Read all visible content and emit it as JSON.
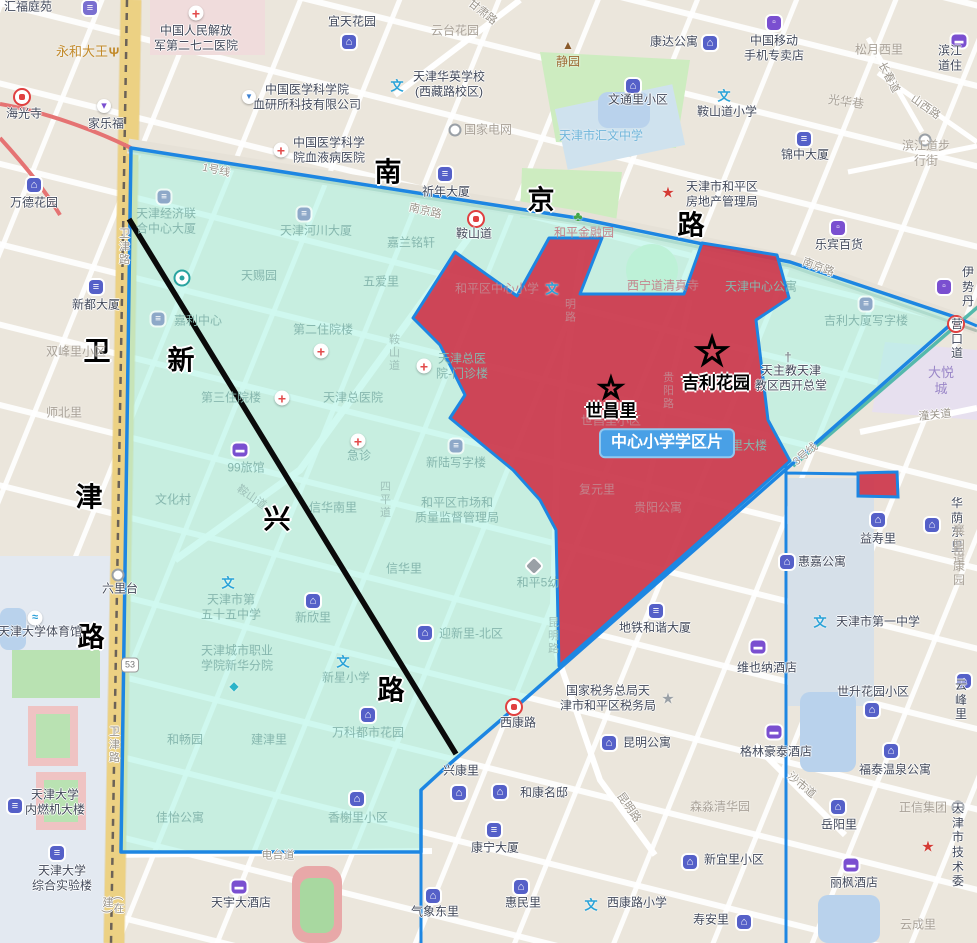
{
  "map": {
    "title": "天津市和平区 中心小学学区片 地图",
    "district_badge": "中心小学学区片",
    "colors": {
      "boundary_blue": "#1d86e2",
      "district_cyan": "rgba(190,250,240,0.6)",
      "school_zone_red": "#ce384c",
      "badge_blue": "#49a0e6",
      "highlight_line_black": "#000000",
      "weijin_road_yellow": "#f2d98f"
    },
    "labels": [
      {
        "t": "汇福庭苑",
        "x": 28,
        "y": 7,
        "c": "dark",
        "i": "bank",
        "ix": 90,
        "iy": 8
      },
      {
        "t": "永和大王",
        "x": 82,
        "y": 52,
        "c": "orange",
        "i": "fork",
        "ix": 114,
        "iy": 52
      },
      {
        "t": "中国人民解放\n军第二七二医院",
        "x": 196,
        "y": 38,
        "c": "dark",
        "i": "cross",
        "ix": 196,
        "iy": 13
      },
      {
        "t": "海光寺",
        "x": 24,
        "y": 114,
        "c": "dark",
        "i": "metro",
        "ix": 22,
        "iy": 97
      },
      {
        "t": "家乐福",
        "x": 106,
        "y": 124,
        "c": "dark",
        "i": "cart",
        "ix": 104,
        "iy": 106
      },
      {
        "t": "中国医学科学院\n血研所科技有限公司",
        "x": 307,
        "y": 97,
        "c": "dark",
        "i": "flask",
        "ix": 249,
        "iy": 97
      },
      {
        "t": "中国医学科学\n院血液病医院",
        "x": 329,
        "y": 150,
        "c": "dark",
        "i": "cross",
        "ix": 281,
        "iy": 150
      },
      {
        "t": "万德花园",
        "x": 34,
        "y": 203,
        "c": "dark",
        "i": "home",
        "ix": 34,
        "iy": 185
      },
      {
        "t": "宜天花园",
        "x": 352,
        "y": 22,
        "c": "dark",
        "i": "home",
        "ix": 349,
        "iy": 42
      },
      {
        "t": "云台花园",
        "x": 455,
        "y": 31,
        "c": "gray"
      },
      {
        "t": "甘肃路",
        "x": 482,
        "y": 13,
        "c": "road",
        "r": 38
      },
      {
        "t": "静园",
        "x": 568,
        "y": 62,
        "c": "brown",
        "i": "temple",
        "ix": 568,
        "iy": 45
      },
      {
        "t": "天津华英学校\n(西藏路校区)",
        "x": 449,
        "y": 84,
        "c": "dark",
        "i": "school",
        "ix": 397,
        "iy": 86
      },
      {
        "t": "国家电网",
        "x": 488,
        "y": 130,
        "c": "gray",
        "i": "circ",
        "ix": 455,
        "iy": 130
      },
      {
        "t": "文通里小区",
        "x": 638,
        "y": 100,
        "c": "dark",
        "i": "home",
        "ix": 633,
        "iy": 86
      },
      {
        "t": "天津市汇文中学",
        "x": 601,
        "y": 136,
        "c": "blue"
      },
      {
        "t": "康达公寓",
        "x": 674,
        "y": 42,
        "c": "dark",
        "i": "home",
        "ix": 710,
        "iy": 43
      },
      {
        "t": "中国移动\n手机专卖店",
        "x": 774,
        "y": 48,
        "c": "dark",
        "i": "shopbag",
        "ix": 774,
        "iy": 23
      },
      {
        "t": "松月西里",
        "x": 879,
        "y": 50,
        "c": "gray"
      },
      {
        "t": "滨江道住",
        "x": 950,
        "y": 58,
        "c": "dark",
        "i": "bed",
        "ix": 959,
        "iy": 41
      },
      {
        "t": "鞍山道小学",
        "x": 727,
        "y": 112,
        "c": "dark",
        "i": "school",
        "ix": 724,
        "iy": 96
      },
      {
        "t": "光华巷",
        "x": 846,
        "y": 102,
        "c": "gray",
        "r": 8
      },
      {
        "t": "锦中大厦",
        "x": 805,
        "y": 155,
        "c": "dark",
        "i": "bldg",
        "ix": 804,
        "iy": 139
      },
      {
        "t": "滨江道步行街",
        "x": 926,
        "y": 153,
        "c": "gray",
        "i": "circ",
        "ix": 925,
        "iy": 140
      },
      {
        "t": "长春道",
        "x": 888,
        "y": 78,
        "c": "road",
        "r": 62
      },
      {
        "t": "山西路",
        "x": 925,
        "y": 108,
        "c": "road",
        "r": 35
      },
      {
        "t": "天津市和平区\n房地产管理局",
        "x": 722,
        "y": 194,
        "c": "dark",
        "i": "starred",
        "ix": 668,
        "iy": 193
      },
      {
        "t": "乐宾百货",
        "x": 839,
        "y": 245,
        "c": "dark",
        "i": "shopbag",
        "ix": 838,
        "iy": 228
      },
      {
        "t": "伊势丹",
        "x": 968,
        "y": 287,
        "c": "dark",
        "i": "shopbag",
        "ix": 944,
        "iy": 287
      },
      {
        "t": "营口道",
        "x": 957,
        "y": 339,
        "c": "dark",
        "i": "metro",
        "ix": 956,
        "iy": 324
      },
      {
        "t": "大悦城",
        "x": 941,
        "y": 381,
        "c": "purple"
      },
      {
        "t": "潼关道",
        "x": 935,
        "y": 416,
        "c": "road",
        "r": -6
      },
      {
        "t": "祈年大厦",
        "x": 446,
        "y": 192,
        "c": "dark",
        "i": "bldg",
        "ix": 445,
        "iy": 174
      },
      {
        "t": "鞍山道",
        "x": 474,
        "y": 234,
        "c": "dark",
        "i": "metro",
        "ix": 476,
        "iy": 219
      },
      {
        "t": "南京路",
        "x": 425,
        "y": 212,
        "c": "road",
        "r": 13
      },
      {
        "t": "南京路",
        "x": 818,
        "y": 268,
        "c": "road",
        "r": 20
      },
      {
        "t": "1号线",
        "x": 216,
        "y": 171,
        "c": "road",
        "r": 12
      },
      {
        "t": "3号线",
        "x": 806,
        "y": 455,
        "c": "road",
        "r": -40
      },
      {
        "t": "南",
        "x": 388,
        "y": 173,
        "c": "big"
      },
      {
        "t": "京",
        "x": 541,
        "y": 201,
        "c": "big"
      },
      {
        "t": "路",
        "x": 691,
        "y": 226,
        "c": "big"
      },
      {
        "t": "卫",
        "x": 97,
        "y": 352,
        "c": "big"
      },
      {
        "t": "津",
        "x": 89,
        "y": 498,
        "c": "big"
      },
      {
        "t": "路",
        "x": 91,
        "y": 638,
        "c": "big"
      },
      {
        "t": "新",
        "x": 181,
        "y": 361,
        "c": "big"
      },
      {
        "t": "兴",
        "x": 277,
        "y": 520,
        "c": "big"
      },
      {
        "t": "路",
        "x": 391,
        "y": 691,
        "c": "big"
      },
      {
        "t": "天津经济联\n合中心大厦",
        "x": 166,
        "y": 221,
        "c": "dim",
        "i": "bldgdim",
        "ix": 164,
        "iy": 197
      },
      {
        "t": "天津河川大厦",
        "x": 316,
        "y": 231,
        "c": "dim",
        "i": "bldgdim",
        "ix": 304,
        "iy": 214
      },
      {
        "t": "嘉兰铭轩",
        "x": 411,
        "y": 243,
        "c": "dim"
      },
      {
        "t": "天赐园",
        "x": 259,
        "y": 276,
        "c": "dim"
      },
      {
        "t": "五爱里",
        "x": 381,
        "y": 282,
        "c": "dim"
      },
      {
        "t": "嘉利中心",
        "x": 198,
        "y": 321,
        "c": "dim",
        "i": "bldgdim",
        "ix": 158,
        "iy": 319
      },
      {
        "t": "",
        "x": 182,
        "y": 278,
        "c": "dim",
        "i": "mobile",
        "ix": 182,
        "iy": 278
      },
      {
        "t": "第二住院楼",
        "x": 323,
        "y": 330,
        "c": "dim",
        "i": "cross",
        "ix": 321,
        "iy": 351
      },
      {
        "t": "第三住院楼",
        "x": 231,
        "y": 398,
        "c": "dim",
        "i": "cross",
        "ix": 282,
        "iy": 398
      },
      {
        "t": "双峰里小区",
        "x": 76,
        "y": 352,
        "c": "gray"
      },
      {
        "t": "新都大厦",
        "x": 96,
        "y": 305,
        "c": "dark",
        "i": "bldg",
        "ix": 96,
        "iy": 287
      },
      {
        "t": "师北里",
        "x": 64,
        "y": 413,
        "c": "gray"
      },
      {
        "t": "卫津路",
        "x": 123,
        "y": 247,
        "c": "road",
        "v": true
      },
      {
        "t": "卫津路",
        "x": 113,
        "y": 745,
        "c": "road",
        "v": true
      },
      {
        "t": "(在建)",
        "x": 112,
        "y": 906,
        "c": "road",
        "v": true
      },
      {
        "t": "鞍山道",
        "x": 393,
        "y": 353,
        "c": "roaddim",
        "v": true
      },
      {
        "t": "鞍山道",
        "x": 251,
        "y": 498,
        "c": "roaddim",
        "r": 35
      },
      {
        "t": "天津总医\n院-门诊楼",
        "x": 462,
        "y": 366,
        "c": "dim",
        "i": "cross",
        "ix": 424,
        "iy": 366
      },
      {
        "t": "天津总医院",
        "x": 353,
        "y": 398,
        "c": "dim"
      },
      {
        "t": "急诊",
        "x": 359,
        "y": 456,
        "c": "dim",
        "i": "cross",
        "ix": 358,
        "iy": 441
      },
      {
        "t": "99旅馆",
        "x": 246,
        "y": 468,
        "c": "dim",
        "i": "bed",
        "ix": 240,
        "iy": 450
      },
      {
        "t": "文化村",
        "x": 173,
        "y": 500,
        "c": "dim"
      },
      {
        "t": "信华南里",
        "x": 333,
        "y": 508,
        "c": "dim"
      },
      {
        "t": "四平道",
        "x": 384,
        "y": 500,
        "c": "roaddim",
        "v": true
      },
      {
        "t": "新陆写字楼",
        "x": 456,
        "y": 463,
        "c": "dim",
        "i": "bldgdim",
        "ix": 456,
        "iy": 446
      },
      {
        "t": "和平区市场和\n质量监督管理局",
        "x": 457,
        "y": 510,
        "c": "dim"
      },
      {
        "t": "信华里",
        "x": 404,
        "y": 569,
        "c": "dim"
      },
      {
        "t": "天津市第\n五十五中学",
        "x": 231,
        "y": 607,
        "c": "dim",
        "i": "school",
        "ix": 228,
        "iy": 583
      },
      {
        "t": "新欣里",
        "x": 313,
        "y": 618,
        "c": "dim",
        "i": "home",
        "ix": 313,
        "iy": 601
      },
      {
        "t": "天津城市职业\n学院新华分院",
        "x": 237,
        "y": 658,
        "c": "dim",
        "i": "cap",
        "ix": 234,
        "iy": 686
      },
      {
        "t": "新星小学",
        "x": 346,
        "y": 678,
        "c": "dim",
        "i": "school",
        "ix": 343,
        "iy": 662
      },
      {
        "t": "迎新里-北区",
        "x": 471,
        "y": 634,
        "c": "dim",
        "i": "home",
        "ix": 425,
        "iy": 633
      },
      {
        "t": "和平5幼",
        "x": 538,
        "y": 583,
        "c": "dim",
        "i": "tag",
        "ix": 534,
        "iy": 566
      },
      {
        "t": "昆明路",
        "x": 552,
        "y": 636,
        "c": "roaddim",
        "v": true
      },
      {
        "t": "和畅园",
        "x": 185,
        "y": 740,
        "c": "dim"
      },
      {
        "t": "建津里",
        "x": 269,
        "y": 740,
        "c": "dim"
      },
      {
        "t": "万科都市花园",
        "x": 368,
        "y": 733,
        "c": "dim",
        "i": "home",
        "ix": 368,
        "iy": 715
      },
      {
        "t": "佳怡公寓",
        "x": 180,
        "y": 818,
        "c": "dim"
      },
      {
        "t": "香榭里小区",
        "x": 358,
        "y": 818,
        "c": "dim",
        "i": "home",
        "ix": 357,
        "iy": 799
      },
      {
        "t": "电台道",
        "x": 278,
        "y": 856,
        "c": "road"
      },
      {
        "t": "六里台",
        "x": 120,
        "y": 589,
        "c": "dark",
        "i": "circ",
        "ix": 118,
        "iy": 575
      },
      {
        "t": "53",
        "x": 130,
        "y": 665,
        "c": "shield"
      },
      {
        "t": "和平金融园",
        "x": 584,
        "y": 233,
        "c": "rdim",
        "i": "tree",
        "ix": 578,
        "iy": 216
      },
      {
        "t": "西宁道清真寺",
        "x": 663,
        "y": 286,
        "c": "rdim"
      },
      {
        "t": "和平区中心小学",
        "x": 497,
        "y": 289,
        "c": "rdim",
        "i": "school",
        "ix": 552,
        "iy": 289
      },
      {
        "t": "明路",
        "x": 569,
        "y": 311,
        "c": "rroad",
        "v": true
      },
      {
        "t": "贵阳路",
        "x": 667,
        "y": 391,
        "c": "rroad",
        "v": true
      },
      {
        "t": "世昌里小区",
        "x": 611,
        "y": 421,
        "c": "rdim"
      },
      {
        "t": "复元里",
        "x": 597,
        "y": 490,
        "c": "rdim"
      },
      {
        "t": "贵阳公寓",
        "x": 658,
        "y": 508,
        "c": "rdim"
      },
      {
        "t": "世昌里大楼",
        "x": 737,
        "y": 446,
        "c": "dim"
      },
      {
        "t": "天津中心公寓",
        "x": 761,
        "y": 287,
        "c": "dim"
      },
      {
        "t": "吉利大厦写字楼",
        "x": 866,
        "y": 321,
        "c": "dim",
        "i": "bldgdim",
        "ix": 866,
        "iy": 304
      },
      {
        "t": "天主教天津\n教区西开总堂",
        "x": 791,
        "y": 378,
        "c": "dark",
        "i": "church",
        "ix": 788,
        "iy": 357
      },
      {
        "t": "世昌里",
        "x": 611,
        "y": 412,
        "c": "name",
        "i": "star-big",
        "ix": 611,
        "iy": 389,
        "is": 30
      },
      {
        "t": "吉利花园",
        "x": 716,
        "y": 384,
        "c": "name",
        "i": "star-big",
        "ix": 712,
        "iy": 352,
        "is": 40
      },
      {
        "t": "中心小学学区片",
        "x": 667,
        "y": 443,
        "c": "badge"
      },
      {
        "t": "地铁和谐大厦",
        "x": 655,
        "y": 628,
        "c": "dark",
        "i": "bldg",
        "ix": 656,
        "iy": 611
      },
      {
        "t": "国家税务总局天\n津市和平区税务局",
        "x": 608,
        "y": 698,
        "c": "dark",
        "i": "stargray",
        "ix": 668,
        "iy": 699
      },
      {
        "t": "西康路",
        "x": 518,
        "y": 723,
        "c": "dark",
        "i": "metro",
        "ix": 514,
        "iy": 707
      },
      {
        "t": "兴康里",
        "x": 461,
        "y": 771,
        "c": "dark",
        "i": "home",
        "ix": 459,
        "iy": 793
      },
      {
        "t": "昆明公寓",
        "x": 647,
        "y": 743,
        "c": "dark",
        "i": "home",
        "ix": 609,
        "iy": 743
      },
      {
        "t": "和康名邸",
        "x": 544,
        "y": 793,
        "c": "dark",
        "i": "home",
        "ix": 500,
        "iy": 792
      },
      {
        "t": "康宁大厦",
        "x": 495,
        "y": 848,
        "c": "dark",
        "i": "bldg",
        "ix": 494,
        "iy": 830
      },
      {
        "t": "惠民里",
        "x": 523,
        "y": 903,
        "c": "dark",
        "i": "home",
        "ix": 521,
        "iy": 887
      },
      {
        "t": "西康路小学",
        "x": 637,
        "y": 903,
        "c": "dark",
        "i": "school",
        "ix": 591,
        "iy": 905
      },
      {
        "t": "寿安里",
        "x": 711,
        "y": 920,
        "c": "dark",
        "i": "home",
        "ix": 744,
        "iy": 922
      },
      {
        "t": "新宜里小区",
        "x": 734,
        "y": 860,
        "c": "dark",
        "i": "home",
        "ix": 690,
        "iy": 862
      },
      {
        "t": "森淼清华园",
        "x": 720,
        "y": 807,
        "c": "gray"
      },
      {
        "t": "格林豪泰酒店",
        "x": 776,
        "y": 752,
        "c": "dark",
        "i": "bed",
        "ix": 774,
        "iy": 732
      },
      {
        "t": "沙市道",
        "x": 801,
        "y": 786,
        "c": "road",
        "r": 40
      },
      {
        "t": "昆明路",
        "x": 628,
        "y": 808,
        "c": "road",
        "r": 55
      },
      {
        "t": "福泰温泉公寓",
        "x": 895,
        "y": 770,
        "c": "dark",
        "i": "home",
        "ix": 891,
        "iy": 751
      },
      {
        "t": "岳阳里",
        "x": 839,
        "y": 825,
        "c": "dark",
        "i": "home",
        "ix": 838,
        "iy": 807
      },
      {
        "t": "正信集团",
        "x": 923,
        "y": 808,
        "c": "gray",
        "i": "circ",
        "ix": 958,
        "iy": 807
      },
      {
        "t": "丽枫酒店",
        "x": 854,
        "y": 883,
        "c": "dark",
        "i": "bed",
        "ix": 851,
        "iy": 865
      },
      {
        "t": "云成里",
        "x": 918,
        "y": 925,
        "c": "gray"
      },
      {
        "t": "天津市\n技术委",
        "x": 958,
        "y": 845,
        "c": "dark",
        "i": "starred",
        "ix": 928,
        "iy": 847
      },
      {
        "t": "天宇大酒店",
        "x": 241,
        "y": 903,
        "c": "dark",
        "i": "bed",
        "ix": 239,
        "iy": 887
      },
      {
        "t": "气象东里",
        "x": 435,
        "y": 912,
        "c": "dark",
        "i": "home",
        "ix": 433,
        "iy": 896
      },
      {
        "t": "惠嘉公寓",
        "x": 822,
        "y": 562,
        "c": "dark",
        "i": "home",
        "ix": 787,
        "iy": 562
      },
      {
        "t": "益寿里",
        "x": 878,
        "y": 539,
        "c": "dark",
        "i": "home",
        "ix": 878,
        "iy": 520
      },
      {
        "t": "华荫东里",
        "x": 957,
        "y": 525,
        "c": "dark",
        "i": "home",
        "ix": 932,
        "iy": 525
      },
      {
        "t": "襄阳道",
        "x": 959,
        "y": 545,
        "c": "gray"
      },
      {
        "t": "岳康园",
        "x": 959,
        "y": 566,
        "c": "gray"
      },
      {
        "t": "天津市第一中学",
        "x": 878,
        "y": 622,
        "c": "dark",
        "i": "school",
        "ix": 820,
        "iy": 622
      },
      {
        "t": "维也纳酒店",
        "x": 767,
        "y": 668,
        "c": "dark",
        "i": "bed",
        "ix": 758,
        "iy": 647
      },
      {
        "t": "世升花园小区",
        "x": 873,
        "y": 692,
        "c": "dark",
        "i": "home",
        "ix": 872,
        "iy": 710
      },
      {
        "t": "云峰里",
        "x": 961,
        "y": 700,
        "c": "dark",
        "i": "home",
        "ix": 964,
        "iy": 681
      },
      {
        "t": "天津大学体育馆",
        "x": 40,
        "y": 632,
        "c": "dark",
        "i": "swim",
        "ix": 35,
        "iy": 618
      },
      {
        "t": "天津大学\n内燃机大楼",
        "x": 55,
        "y": 802,
        "c": "dark",
        "i": "bldg",
        "ix": 15,
        "iy": 806
      },
      {
        "t": "天津大学\n综合实验楼",
        "x": 62,
        "y": 878,
        "c": "dark",
        "i": "bldg",
        "ix": 57,
        "iy": 853
      }
    ]
  }
}
